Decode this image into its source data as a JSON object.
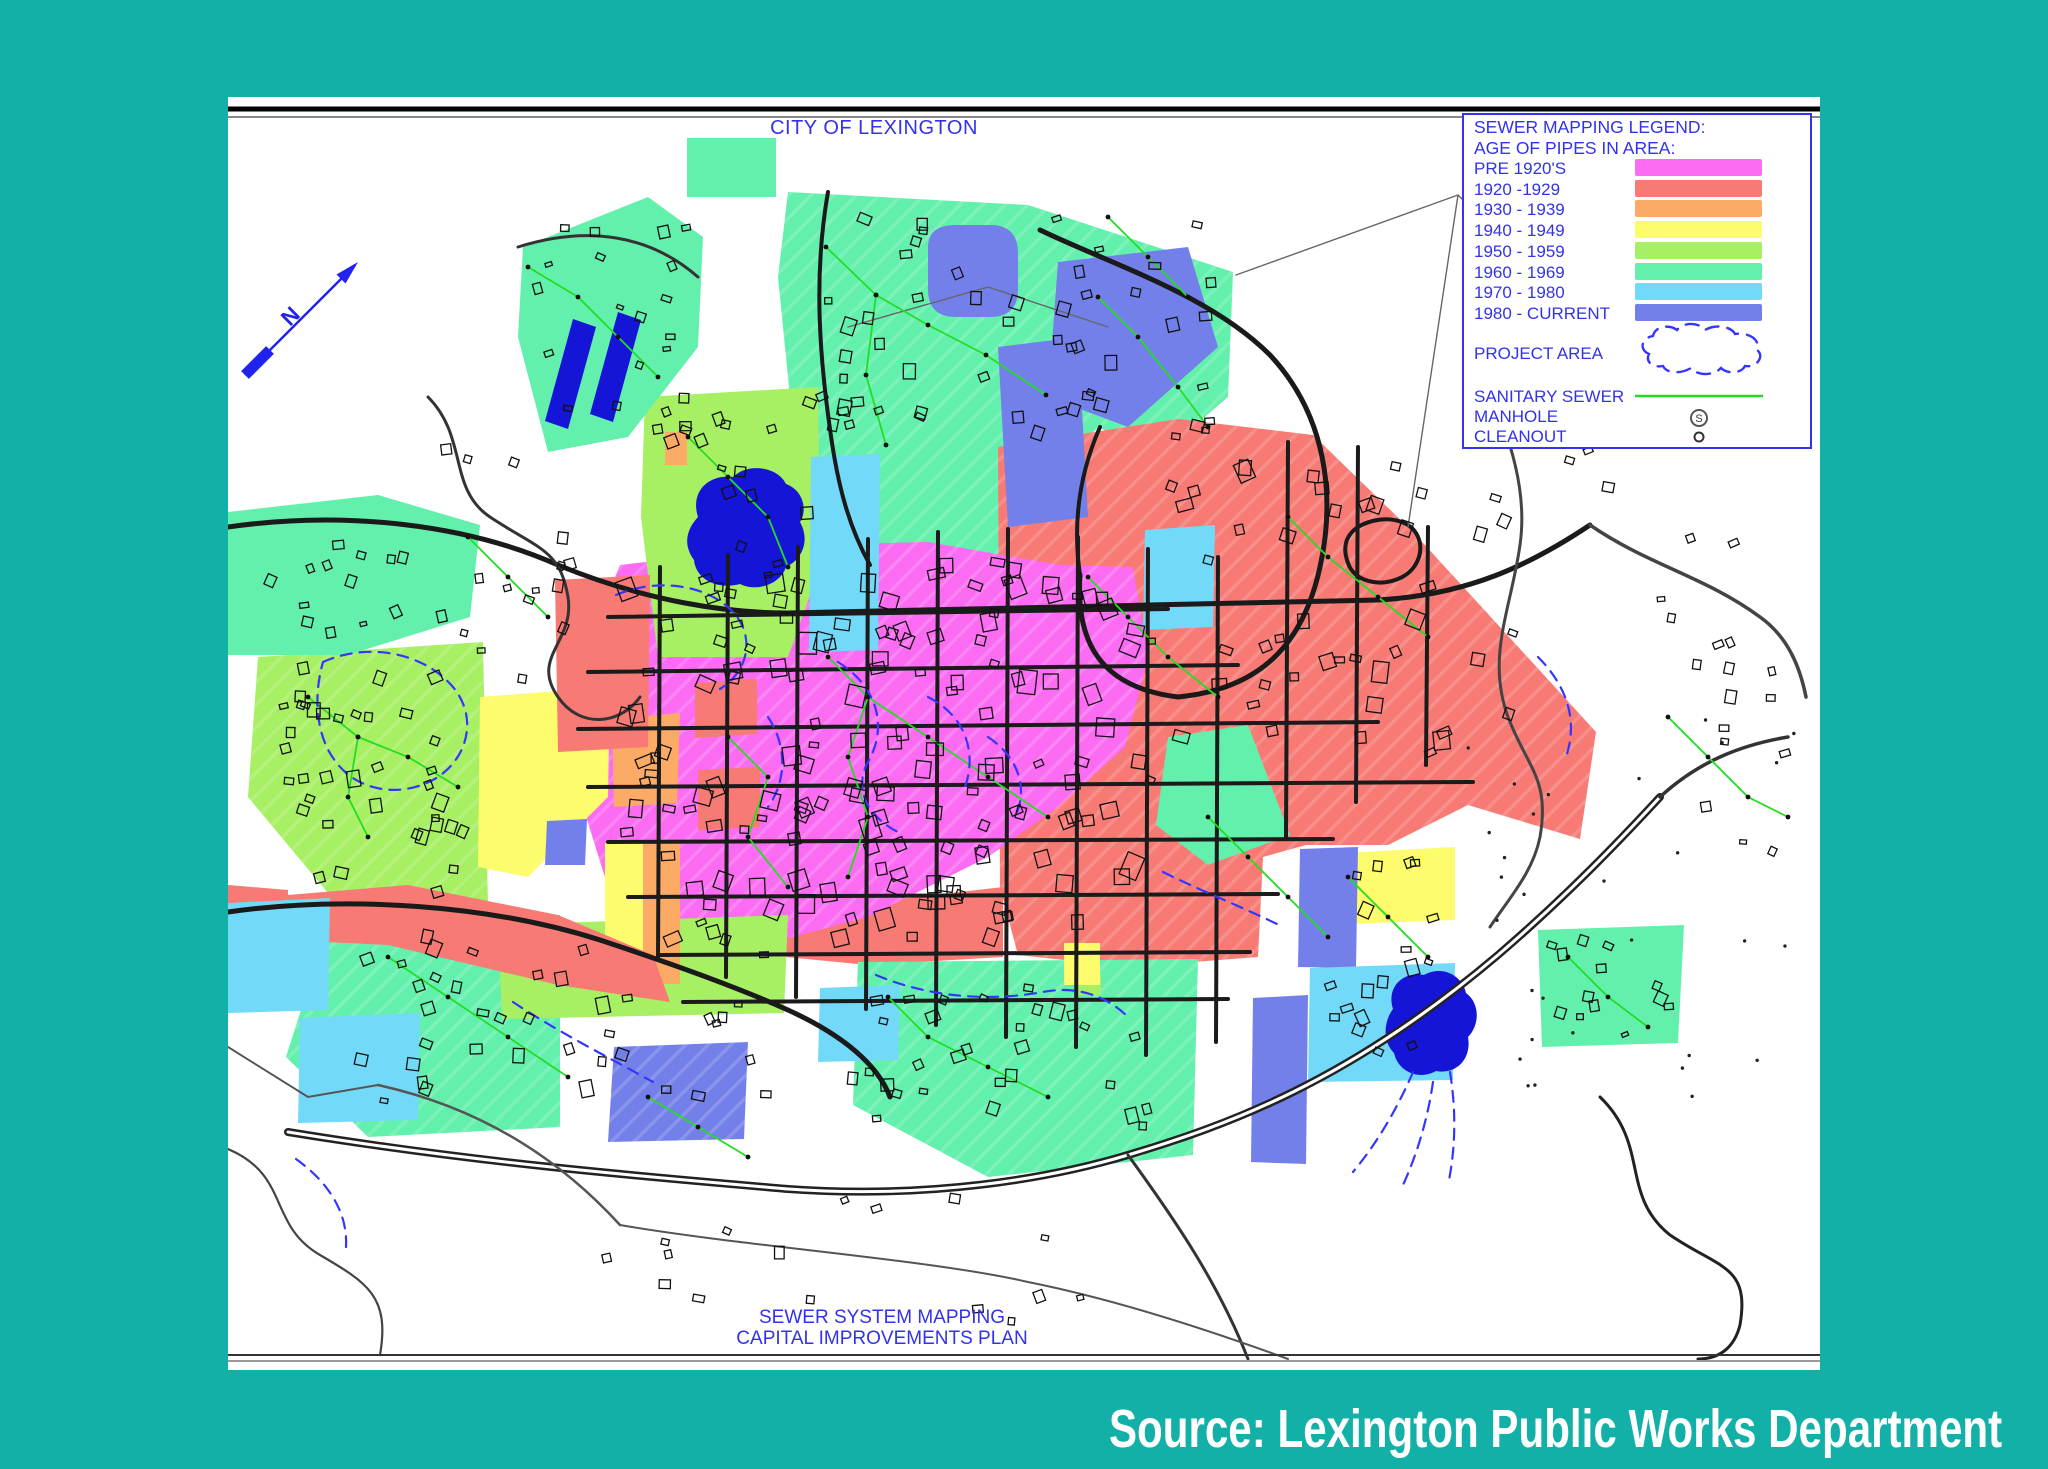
{
  "page": {
    "background_color": "#13b0a8",
    "title": "CITY OF LEXINGTON",
    "bottom_line1": "SEWER SYSTEM MAPPING",
    "bottom_line2": "CAPITAL IMPROVEMENTS PLAN",
    "source_caption": "Source: Lexington Public Works Department",
    "text_color": "#3232ee"
  },
  "legend": {
    "title": "SEWER MAPPING LEGEND:",
    "subtitle": "AGE OF PIPES IN AREA:",
    "entries": [
      {
        "label": "PRE 1920'S",
        "key": "pre1920",
        "color": "#fb6cf2"
      },
      {
        "label": "1920 -1929",
        "key": "a1920",
        "color": "#f87a74"
      },
      {
        "label": "1930 - 1939",
        "key": "a1930",
        "color": "#fbab66"
      },
      {
        "label": "1940 - 1949",
        "key": "a1940",
        "color": "#fcfc6c"
      },
      {
        "label": "1950 - 1959",
        "key": "a1950",
        "color": "#a7ef63"
      },
      {
        "label": "1960 - 1969",
        "key": "a1960",
        "color": "#63f0ad"
      },
      {
        "label": "1970 - 1980",
        "key": "a1970",
        "color": "#72d9f8"
      },
      {
        "label": "1980 - CURRENT",
        "key": "a1980",
        "color": "#7480ea"
      }
    ],
    "project_area_label": "PROJECT AREA",
    "sanitary_sewer_label": "SANITARY SEWER",
    "manhole_label": "MANHOLE",
    "manhole_symbol": "S",
    "cleanout_label": "CLEANOUT",
    "sewer_color": "#23dd23",
    "project_color": "#3535ff"
  },
  "north_arrow": {
    "label": "N",
    "color": "#2222ee",
    "x1": 17,
    "y1": 278,
    "x2": 127,
    "y2": 168
  },
  "map": {
    "width": 1592,
    "height": 1273,
    "road_color": "#1a1a1a",
    "blob_color": "#1515d8",
    "rules": [
      {
        "y": 12,
        "w": 5,
        "c": "#000000"
      },
      {
        "y": 20,
        "w": 2,
        "c": "#888888"
      },
      {
        "y": 1258,
        "w": 2,
        "c": "#333333"
      },
      {
        "y": 1264,
        "w": 2,
        "c": "#999999"
      }
    ],
    "regions": [
      {
        "k": "a1960",
        "hatch": true,
        "d": "M560,95 L800,108 L1005,175 L1000,300 L930,360 L870,330 L800,420 L770,500 L700,545 L640,520 L600,450 L565,330 L550,180 Z"
      },
      {
        "k": "a1920",
        "hatch": true,
        "d": "M770,350 L950,322 L1085,338 L1185,435 L1368,635 L1352,742 L1240,708 L1160,748 L1078,748 L1035,760 L1030,860 L900,870 L790,858 L772,790 Z"
      },
      {
        "k": "a1920",
        "d": "M560,815 L775,790 L775,860 L640,868 L558,860 Z"
      },
      {
        "k": "pre1920",
        "hatch": true,
        "d": "M392,468 L560,448 L700,445 L832,468 L905,470 L920,560 L897,650 L830,710 L760,760 L640,820 L520,852 L430,840 L380,790 L352,700 L355,560 Z"
      },
      {
        "k": "a1950",
        "hatch": true,
        "d": "M30,560 L255,545 L260,810 L120,820 L20,700 Z"
      },
      {
        "k": "a1950",
        "d": "M417,300 L590,290 L592,470 L560,560 L430,560 L413,420 Z"
      },
      {
        "k": "a1960",
        "d": "M0,415 L150,398 L252,428 L242,520 L120,558 L0,558 Z"
      },
      {
        "k": "a1960",
        "hatch": true,
        "d": "M100,828 L332,818 L332,1030 L140,1040 L58,960 Z"
      },
      {
        "k": "a1960",
        "hatch": true,
        "d": "M630,865 L970,862 L965,1058 L760,1080 L625,1008 Z"
      },
      {
        "k": "a1960",
        "d": "M1310,833 L1456,828 L1450,946 L1314,950 Z"
      },
      {
        "k": "a1960",
        "d": "M940,640 L1020,628 L1062,738 L980,768 L928,728 Z"
      },
      {
        "k": "a1950",
        "d": "M270,828 L560,818 L556,916 L274,922 Z"
      },
      {
        "k": "a1950",
        "d": "M850,877 L873,877 L873,898 L850,898 Z"
      },
      {
        "k": "a1940",
        "d": "M252,600 L382,590 L380,700 L300,780 L250,770 Z"
      },
      {
        "k": "a1940",
        "d": "M377,746 L415,746 L415,887 L377,887 Z"
      },
      {
        "k": "a1930",
        "d": "M384,622 L452,616 L449,706 L386,710 Z"
      },
      {
        "k": "a1930",
        "d": "M415,746 L452,746 L452,887 L415,887 Z"
      },
      {
        "k": "a1930",
        "d": "M437,335 L459,335 L459,368 L437,368 Z"
      },
      {
        "k": "a1940",
        "d": "M1117,756 L1227,750 L1227,823 L1117,827 Z"
      },
      {
        "k": "a1940",
        "d": "M836,846 L872,846 L872,888 L836,888 Z"
      },
      {
        "k": "a1920",
        "d": "M327,483 L422,478 L420,650 L330,655 Z"
      },
      {
        "k": "a1920",
        "d": "M60,798 L180,788 L330,818 L425,858 L442,905 L330,888 L160,848 L60,843 Z"
      },
      {
        "k": "a1920",
        "d": "M0,788 L60,793 L60,903 L0,898 Z"
      },
      {
        "k": "a1920",
        "d": "M467,586 L529,582 L529,637 L467,641 Z"
      },
      {
        "k": "a1920",
        "d": "M470,673 L532,670 L532,730 L470,733 Z"
      },
      {
        "k": "a1980",
        "d": "M700,150 Q700,128 728,128 L762,128 Q790,128 790,156 L790,192 Q790,220 762,220 L728,220 Q700,220 700,192 Z"
      },
      {
        "k": "a1980",
        "d": "M830,165 L960,150 L990,250 L900,330 L820,300 Z"
      },
      {
        "k": "a1980",
        "d": "M770,250 L850,240 L860,420 L780,430 Z"
      },
      {
        "k": "a1980",
        "d": "M1072,752 L1130,750 L1128,871 L1070,870 Z"
      },
      {
        "k": "a1980",
        "d": "M1025,901 L1080,898 L1078,1067 L1023,1065 Z"
      },
      {
        "k": "a1980",
        "hatch": true,
        "d": "M386,950 L520,945 L516,1042 L380,1045 Z"
      },
      {
        "k": "a1980",
        "d": "M319,724 L359,722 L357,768 L317,768 Z"
      },
      {
        "k": "a1970",
        "d": "M0,806 L102,801 L100,913 L0,916 Z"
      },
      {
        "k": "a1970",
        "d": "M72,921 L192,916 L190,1023 L70,1026 Z"
      },
      {
        "k": "a1970",
        "d": "M592,891 L672,888 L670,963 L590,965 Z"
      },
      {
        "k": "a1970",
        "d": "M1082,871 L1227,866 L1225,983 L1080,985 Z"
      },
      {
        "k": "a1970",
        "d": "M583,360 L652,357 L650,553 L581,555 Z"
      },
      {
        "k": "a1970",
        "d": "M917,433 L987,428 L985,530 L915,533 Z"
      },
      {
        "k": "a1960",
        "d": "M459,41 L548,41 L548,100 L459,100 Z"
      },
      {
        "k": "a1960",
        "d": "M295,150 L420,100 L475,140 L470,250 L400,340 L320,355 L290,240 Z"
      }
    ],
    "blobs": [
      {
        "d": "M345,222 L368,230 L340,332 L317,324 Z"
      },
      {
        "d": "M390,215 L413,223 L385,325 L362,317 Z"
      },
      {
        "d": "M470,420 C462,395 480,377 505,380 C520,365 550,370 558,387 C575,393 580,413 572,425 C582,443 575,462 558,470 C552,488 528,495 512,487 C490,493 468,483 466,463 C455,448 458,433 470,420 Z"
      },
      {
        "d": "M1165,912 C1158,890 1175,874 1196,878 C1214,868 1234,878 1238,896 C1252,906 1252,928 1240,940 C1244,962 1228,978 1208,974 C1190,984 1170,974 1166,956 C1154,944 1156,924 1165,912 Z"
      }
    ],
    "grid": {
      "w": 4,
      "c": "#1b1b1b",
      "segs": [
        [
          380,
          520,
          940,
          512
        ],
        [
          360,
          575,
          1010,
          568
        ],
        [
          350,
          632,
          1150,
          625
        ],
        [
          360,
          690,
          1245,
          685
        ],
        [
          380,
          745,
          1105,
          742
        ],
        [
          400,
          800,
          1050,
          797
        ],
        [
          432,
          858,
          1022,
          855
        ],
        [
          455,
          905,
          1000,
          902
        ],
        [
          432,
          470,
          430,
          860
        ],
        [
          500,
          458,
          498,
          880
        ],
        [
          570,
          450,
          568,
          900
        ],
        [
          640,
          442,
          638,
          912
        ],
        [
          710,
          435,
          708,
          928
        ],
        [
          780,
          432,
          778,
          940
        ],
        [
          850,
          440,
          848,
          950
        ],
        [
          920,
          452,
          918,
          958
        ],
        [
          990,
          460,
          988,
          945
        ],
        [
          1060,
          345,
          1058,
          740
        ],
        [
          1130,
          350,
          1128,
          705
        ],
        [
          1200,
          430,
          1198,
          668
        ]
      ]
    },
    "roads": [
      {
        "d": "M0,430 C120,413 240,428 330,468 C420,505 500,516 560,516",
        "w": 5,
        "c": "#1a1a1a"
      },
      {
        "d": "M560,516 L1150,503 C1240,498 1302,468 1362,428",
        "w": 5,
        "c": "#1a1a1a"
      },
      {
        "d": "M1362,428 C1420,468 1478,480 1532,520 C1560,540 1572,570 1578,600",
        "w": 3.5,
        "c": "#444444"
      },
      {
        "d": "M60,1035 C250,1066 420,1080 560,1092 C700,1102 820,1082 900,1058 C1000,1028 1120,985 1270,858 C1340,798 1395,740 1432,700",
        "w": 8,
        "c": "#222222",
        "casing": true
      },
      {
        "d": "M900,1058 C945,1120 990,1185 1020,1262",
        "w": 3,
        "c": "#333333"
      },
      {
        "d": "M1432,700 C1470,665 1512,648 1560,640",
        "w": 3.5,
        "c": "#333333"
      },
      {
        "d": "M0,815 C120,798 262,808 372,843 C460,872 520,895 560,913 C615,938 650,968 662,1000",
        "w": 5,
        "c": "#1a1a1a"
      },
      {
        "d": "M812,133 C885,168 982,198 1042,258 C1098,318 1108,398 1092,470 C1075,548 1032,592 950,600 C868,590 848,540 852,478",
        "w": 5,
        "c": "#1a1a1a"
      },
      {
        "d": "M852,478 C845,430 850,380 872,330",
        "w": 4,
        "c": "#1a1a1a"
      },
      {
        "d": "M1246,248 C1270,318 1302,378 1292,448 C1283,512 1258,560 1280,620 C1300,672 1322,682 1312,740 C1305,775 1282,800 1262,830",
        "w": 3,
        "c": "#444444"
      },
      {
        "d": "M200,300 C240,340 220,392 262,420 C310,452 332,452 340,500 C347,545 302,560 330,600 C352,632 392,628 412,600",
        "w": 3,
        "c": "#333333"
      },
      {
        "d": "M290,150 C360,128 422,138 470,180",
        "w": 3,
        "c": "#333333"
      },
      {
        "d": "M0,1052 C62,1078 40,1128 92,1158 C140,1186 162,1200 152,1258",
        "w": 2.2,
        "c": "#444444"
      },
      {
        "d": "M1372,1000 C1422,1048 1392,1098 1442,1138 C1492,1172 1522,1168 1512,1228 C1506,1252 1490,1262 1470,1262",
        "w": 3,
        "c": "#222222"
      },
      {
        "d": "M600,95 C585,180 592,262 602,332 C610,392 622,432 642,468",
        "w": 4,
        "c": "#1a1a1a"
      },
      {
        "d": "M392,1128 C520,1150 700,1162 800,1185 C900,1205 1000,1240 1060,1262",
        "w": 2,
        "c": "#555555"
      },
      {
        "d": "M150,988 C250,1010 330,1060 392,1128",
        "w": 2.5,
        "c": "#555555"
      },
      {
        "d": "M1130,430 C1150,418 1178,420 1188,436 C1198,452 1190,474 1170,482 C1150,490 1126,484 1120,466 C1114,450 1118,438 1130,430",
        "w": 4,
        "c": "#1a1a1a"
      },
      {
        "d": "M1008,178 L1230,98 L1342,208",
        "w": 1.4,
        "c": "#666666"
      },
      {
        "d": "M1230,98 L1180,430",
        "w": 1.4,
        "c": "#666666"
      },
      {
        "d": "M620,230 L760,190 L880,230",
        "w": 1.4,
        "c": "#666666"
      },
      {
        "d": "M0,950 L80,1000 L150,988",
        "w": 2,
        "c": "#555555"
      },
      {
        "d": "M1300,40 C1290,120 1296,190 1246,248",
        "w": 3,
        "c": "#444444"
      }
    ],
    "sewers": [
      [
        [
          598,
          150
        ],
        [
          648,
          198
        ],
        [
          700,
          228
        ],
        [
          758,
          258
        ],
        [
          818,
          298
        ]
      ],
      [
        [
          648,
          198
        ],
        [
          638,
          278
        ],
        [
          658,
          348
        ]
      ],
      [
        [
          870,
          200
        ],
        [
          910,
          240
        ],
        [
          950,
          290
        ],
        [
          980,
          330
        ]
      ],
      [
        [
          300,
          170
        ],
        [
          350,
          200
        ],
        [
          390,
          240
        ],
        [
          430,
          280
        ]
      ],
      [
        [
          80,
          600
        ],
        [
          130,
          640
        ],
        [
          180,
          660
        ],
        [
          230,
          690
        ]
      ],
      [
        [
          130,
          640
        ],
        [
          120,
          700
        ],
        [
          140,
          740
        ]
      ],
      [
        [
          460,
          340
        ],
        [
          500,
          380
        ],
        [
          540,
          420
        ],
        [
          560,
          470
        ]
      ],
      [
        [
          600,
          560
        ],
        [
          640,
          600
        ],
        [
          700,
          640
        ],
        [
          760,
          680
        ],
        [
          820,
          720
        ]
      ],
      [
        [
          640,
          600
        ],
        [
          620,
          660
        ],
        [
          640,
          720
        ],
        [
          620,
          780
        ]
      ],
      [
        [
          860,
          480
        ],
        [
          900,
          520
        ],
        [
          940,
          560
        ],
        [
          990,
          600
        ]
      ],
      [
        [
          1060,
          420
        ],
        [
          1100,
          460
        ],
        [
          1150,
          500
        ],
        [
          1200,
          540
        ]
      ],
      [
        [
          160,
          860
        ],
        [
          220,
          900
        ],
        [
          280,
          940
        ],
        [
          340,
          980
        ]
      ],
      [
        [
          660,
          900
        ],
        [
          700,
          940
        ],
        [
          760,
          970
        ],
        [
          820,
          1000
        ]
      ],
      [
        [
          1120,
          780
        ],
        [
          1160,
          820
        ],
        [
          1200,
          860
        ]
      ],
      [
        [
          1340,
          860
        ],
        [
          1380,
          900
        ],
        [
          1420,
          930
        ]
      ],
      [
        [
          420,
          1000
        ],
        [
          470,
          1030
        ],
        [
          520,
          1060
        ]
      ],
      [
        [
          980,
          720
        ],
        [
          1020,
          760
        ],
        [
          1060,
          800
        ],
        [
          1100,
          840
        ]
      ],
      [
        [
          1440,
          620
        ],
        [
          1480,
          660
        ],
        [
          1520,
          700
        ],
        [
          1560,
          720
        ]
      ],
      [
        [
          240,
          440
        ],
        [
          280,
          480
        ],
        [
          320,
          520
        ]
      ],
      [
        [
          880,
          120
        ],
        [
          920,
          160
        ],
        [
          960,
          200
        ]
      ],
      [
        [
          500,
          640
        ],
        [
          540,
          680
        ],
        [
          520,
          740
        ],
        [
          560,
          790
        ]
      ]
    ],
    "squiggles": [
      "M95,565 C140,545 195,555 225,590 C250,620 240,660 210,680 C175,702 130,695 108,665 C88,640 85,600 95,565 Z",
      "M388,498 C430,480 480,488 505,515 C528,540 520,575 492,592",
      "M610,565 C650,590 660,630 640,665 C625,692 640,720 670,735",
      "M700,600 C740,620 750,660 735,695",
      "M648,878 C700,900 760,905 815,895 C850,888 880,900 900,920",
      "M935,775 C975,795 1015,810 1055,830",
      "M285,905 C330,935 380,960 425,985",
      "M1185,975 C1170,1010 1150,1045 1125,1075 M1205,985 C1200,1020 1190,1055 1175,1088 M1222,975 C1228,1012 1228,1050 1220,1088",
      "M760,640 C790,660 800,690 788,718",
      "M540,620 C560,650 558,685 540,710",
      "M68,1062 C100,1085 120,1115 118,1150",
      "M1310,560 C1340,590 1350,625 1338,660"
    ],
    "building_zones": [
      {
        "x": 390,
        "y": 460,
        "w": 540,
        "h": 390,
        "n": 150,
        "s1": 8,
        "s2": 18
      },
      {
        "x": 575,
        "y": 115,
        "w": 420,
        "h": 230,
        "n": 55,
        "s1": 7,
        "s2": 13
      },
      {
        "x": 45,
        "y": 560,
        "w": 200,
        "h": 245,
        "n": 38,
        "s1": 7,
        "s2": 13
      },
      {
        "x": 425,
        "y": 300,
        "w": 160,
        "h": 250,
        "n": 22,
        "s1": 7,
        "s2": 12
      },
      {
        "x": 115,
        "y": 832,
        "w": 430,
        "h": 175,
        "n": 40,
        "s1": 7,
        "s2": 13
      },
      {
        "x": 930,
        "y": 350,
        "w": 330,
        "h": 320,
        "n": 40,
        "s1": 8,
        "s2": 16
      },
      {
        "x": 610,
        "y": 880,
        "w": 330,
        "h": 160,
        "n": 30,
        "s1": 7,
        "s2": 13
      },
      {
        "x": 1085,
        "y": 760,
        "w": 135,
        "h": 200,
        "n": 18,
        "s1": 7,
        "s2": 12
      },
      {
        "x": 300,
        "y": 115,
        "w": 165,
        "h": 225,
        "n": 18,
        "s1": 6,
        "s2": 11
      },
      {
        "x": 205,
        "y": 305,
        "w": 150,
        "h": 290,
        "n": 16,
        "s1": 6,
        "s2": 11
      },
      {
        "x": 1255,
        "y": 300,
        "w": 260,
        "h": 340,
        "n": 13,
        "s1": 7,
        "s2": 12
      },
      {
        "x": 1315,
        "y": 838,
        "w": 135,
        "h": 105,
        "n": 13,
        "s1": 6,
        "s2": 11
      },
      {
        "x": 320,
        "y": 1090,
        "w": 620,
        "h": 140,
        "n": 16,
        "s1": 6,
        "s2": 12
      },
      {
        "x": 1460,
        "y": 430,
        "w": 120,
        "h": 380,
        "n": 12,
        "s1": 6,
        "s2": 10
      },
      {
        "x": 20,
        "y": 420,
        "w": 220,
        "h": 130,
        "n": 14,
        "s1": 6,
        "s2": 11
      }
    ],
    "tree_dots": {
      "x": 1240,
      "y": 620,
      "w": 330,
      "h": 420,
      "n": 30,
      "r": 1.7
    }
  }
}
